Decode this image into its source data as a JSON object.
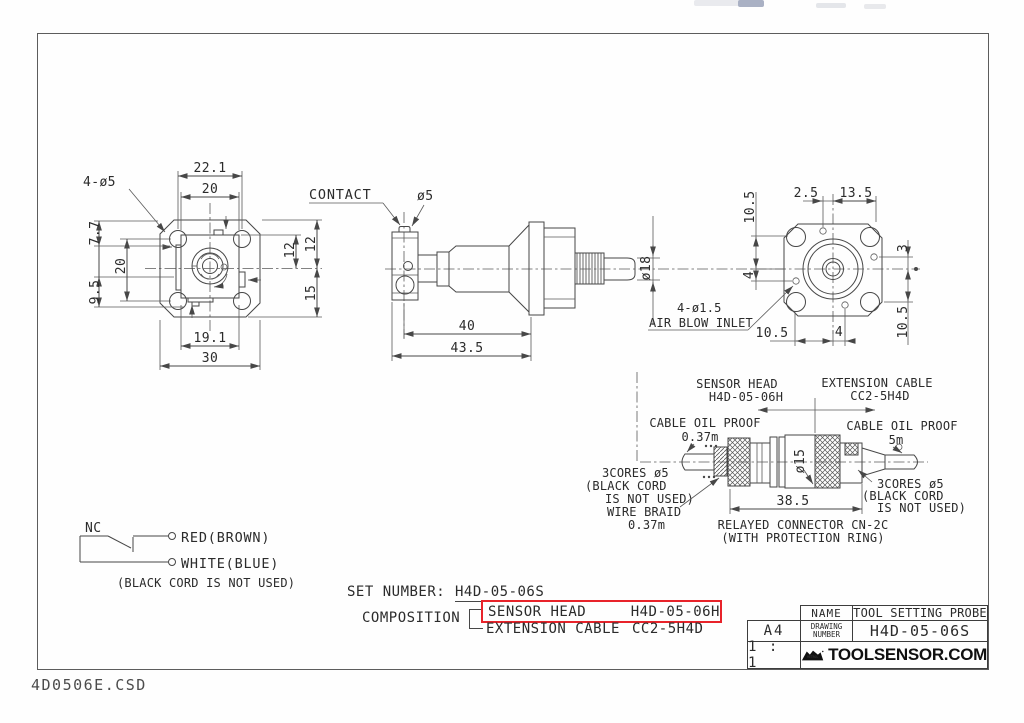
{
  "front_view": {
    "hole_callout": "4-ø5",
    "dim_top_outer": "22.1",
    "dim_top_inner": "20",
    "dim_left_top": "7.7",
    "dim_left_bottom": "9.5",
    "dim_left_inner": "20",
    "dim_right_top": "12",
    "dim_right_inner": "12",
    "dim_right_bottom": "15",
    "dim_bottom_inner": "19.1",
    "dim_bottom_outer": "30"
  },
  "side_view": {
    "contact_label": "CONTACT",
    "contact_dia": "ø5",
    "shaft_dia": "ø18",
    "dim_body": "40",
    "dim_overall": "43.5"
  },
  "rear_view": {
    "dim_top_left": "2.5",
    "dim_top_right": "13.5",
    "dim_left_top": "10.5",
    "dim_left_mid": "4",
    "dim_right_top": "3",
    "dim_right_bottom": "10.5",
    "dim_bottom_left": "10.5",
    "dim_bottom_mid": "4",
    "air_callout": "4-ø1.5",
    "air_label": "AIR BLOW INLET"
  },
  "cable_assembly": {
    "sensor_head_label": "SENSOR HEAD",
    "sensor_head_model": "H4D-05-06H",
    "extension_label": "EXTENSION CABLE",
    "extension_model": "CC2-5H4D",
    "left_cable_note1": "CABLE OIL PROOF",
    "left_cable_note2": "0.37m",
    "right_cable_note1": "CABLE OIL PROOF",
    "right_cable_note2": "5m",
    "connector_dia": "ø15",
    "left_cores1": "3CORES ø5",
    "left_cores2": "(BLACK CORD",
    "left_cores3": "IS NOT USED)",
    "wire_braid1": "WIRE BRAID",
    "wire_braid2": "0.37m",
    "dim_connector": "38.5",
    "relay_note1": "RELAYED CONNECTOR CN-2C",
    "relay_note2": "(WITH PROTECTION RING)",
    "right_cores1": "3CORES ø5",
    "right_cores2": "(BLACK CORD",
    "right_cores3": "IS NOT USED)"
  },
  "wiring": {
    "contact_type": "NC",
    "wire1": "RED(BROWN)",
    "wire2": "WHITE(BLUE)",
    "note": "(BLACK CORD IS NOT USED)"
  },
  "ordering": {
    "set_number_label": "SET NUMBER:",
    "set_number": "H4D-05-06S",
    "composition_label": "COMPOSITION",
    "item1_name": "SENSOR HEAD",
    "item1_model": "H4D-05-06H",
    "item2_name": "EXTENSION CABLE",
    "item2_model": "CC2-5H4D",
    "highlight_color": "#e8232a"
  },
  "title_block": {
    "name_label": "NAME",
    "name_value": "TOOL SETTING PROBE",
    "drawing_label_line1": "DRAWING",
    "drawing_label_line2": "NUMBER",
    "drawing_number": "H4D-05-06S",
    "paper_size": "A4",
    "scale": "1 : 1",
    "logo_text": "METROL",
    "site": "TOOLSENSOR.COM"
  },
  "footer": {
    "filename": "4D0506E.CSD"
  }
}
